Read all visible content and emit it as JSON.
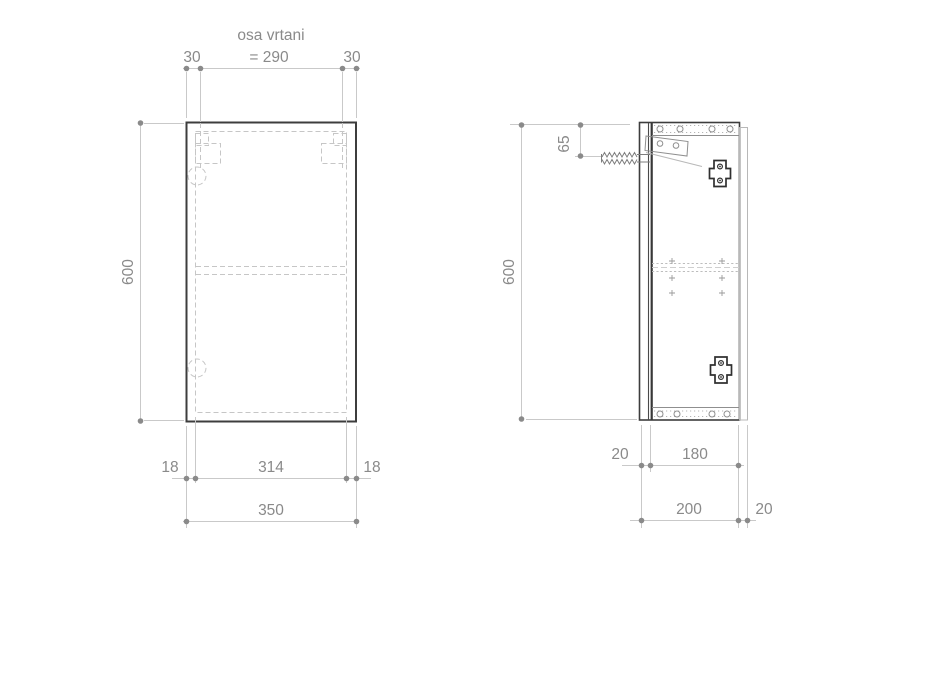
{
  "front": {
    "drill_axis_title": "osa vrtani",
    "drill_axis_value": "= 290",
    "drill_offset_left": "30",
    "drill_offset_right": "30",
    "height": "600",
    "inset_left": "18",
    "inner_width": "314",
    "inset_right": "18",
    "total_width": "350"
  },
  "side": {
    "height": "600",
    "hanger_offset": "65",
    "door_thickness": "20",
    "inner_depth": "180",
    "total_depth": "200",
    "back_offset": "20"
  }
}
